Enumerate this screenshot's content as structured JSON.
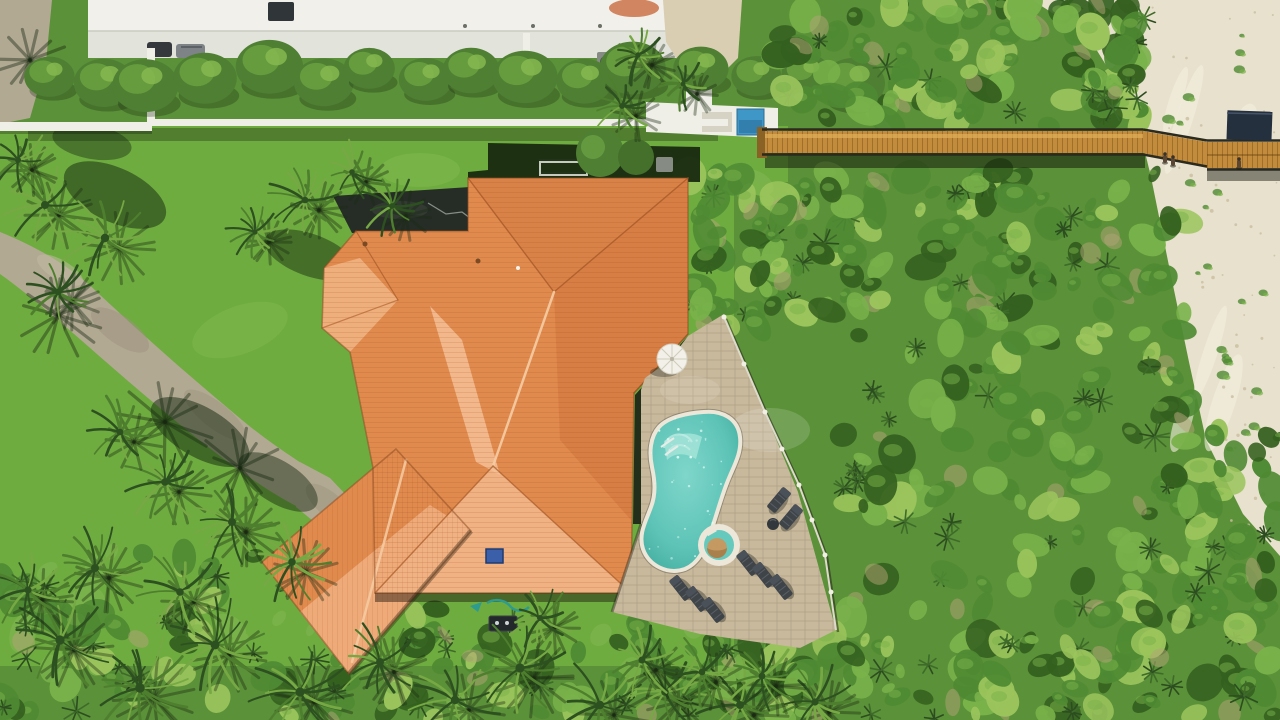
{
  "scene": {
    "description": "Aerial drone photo of a beachfront property: large home with orange terracotta hip roof, freeform turquoise pool with spa on a paver deck, green lawn, palm trees, concrete driveway, neighboring white flat-roof building with hedge row and small blue pool, dense dune scrub, and a wooden boardwalk crossing the dunes to white beach sand on the right.",
    "labels": {
      "house_roof": "orange tile hip roof",
      "pool": "freeform turquoise swimming pool",
      "spa": "round spa with tan cover",
      "boardwalk": "wooden dune crossover boardwalk",
      "beach": "white sand beach",
      "driveway": "concrete driveway",
      "neighbor_building": "white flat-roof building",
      "neighbor_pool": "small blue pool",
      "lawn": "green lawn",
      "scrub": "coastal dune scrub",
      "palms": "palm trees"
    }
  },
  "palette": {
    "lawn": "#6FAC40",
    "lawn_light": "#8CC455",
    "scrub_base": "#5B9138",
    "scrub_dark": "#34601F",
    "scrub_mid": "#4F8A33",
    "scrub_light": "#79B24A",
    "scrub_yellow": "#9BC45C",
    "tan_patch": "#B4A478",
    "sand": "#E8E1CD",
    "sand_light": "#F4EFE0",
    "sand_speck": "#C9BEA0",
    "concrete": "#B2A993",
    "concrete_dark": "#978E79",
    "white_roof": "#F1F0EA",
    "building_face": "#E2E4DC",
    "wall_white": "#EFEFE7",
    "pad_beige": "#D9CEB2",
    "neighbor_pool": "#3F97C8",
    "neighbor_pool_deep": "#2F78A6",
    "roof_main": "#E08A4E",
    "roof_pale": "#F1B283",
    "roof_dark": "#D0743C",
    "roof_valley": "#F4C096",
    "roof_line_dark": "#A85A28",
    "roof_line_light": "#F6CDA4",
    "flat_roof": "#262D26",
    "skylight_blue": "#3B5FA8",
    "band_dark": "#182A10",
    "lanai_dark": "#1C2318",
    "deck_paver": "#C8B99D",
    "pool_coping": "#ECE7D8",
    "pool_water": "#66C9BD",
    "pool_deep": "#45AFA2",
    "pool_shelf": "#A8E5DA",
    "spa_tan": "#C49A62",
    "spa_tan_dark": "#A97F4C",
    "chair_dark": "#3F4449",
    "chair_slat": "#595F66",
    "fence_light": "#DEDACB",
    "wood": "#C28C3C",
    "wood_light": "#DFAE58",
    "wood_dark": "#8A6226",
    "rail_dark": "#2B2A1E",
    "canopy": "#25303E",
    "palm_dark": "#2D5020",
    "palm_mid": "#4E7F2E",
    "palm_light": "#76A844",
    "shadow": "#1A2A12",
    "car_dark": "#35393E",
    "car_gray": "#7E8387",
    "umbrella": "#F2F0E8",
    "rust": "#C96A3F",
    "equip_gray": "#868B84",
    "hose_teal": "#2E9B8F",
    "table_dark": "#23282B"
  },
  "objects": {
    "palms": [
      {
        "x": 60,
        "y": 640,
        "r": 46
      },
      {
        "x": 140,
        "y": 688,
        "r": 48
      },
      {
        "x": 215,
        "y": 645,
        "r": 44
      },
      {
        "x": 300,
        "y": 692,
        "r": 46
      },
      {
        "x": 380,
        "y": 662,
        "r": 40
      },
      {
        "x": 455,
        "y": 700,
        "r": 42
      },
      {
        "x": 520,
        "y": 668,
        "r": 46
      },
      {
        "x": 600,
        "y": 705,
        "r": 42
      },
      {
        "x": 665,
        "y": 692,
        "r": 38
      },
      {
        "x": 740,
        "y": 705,
        "r": 40
      },
      {
        "x": 815,
        "y": 702,
        "r": 36
      },
      {
        "x": 95,
        "y": 568,
        "r": 40
      },
      {
        "x": 28,
        "y": 590,
        "r": 36
      },
      {
        "x": 180,
        "y": 592,
        "r": 38
      },
      {
        "x": 45,
        "y": 205,
        "r": 40
      },
      {
        "x": 105,
        "y": 238,
        "r": 42
      },
      {
        "x": 58,
        "y": 292,
        "r": 33
      },
      {
        "x": 18,
        "y": 160,
        "r": 30
      },
      {
        "x": 305,
        "y": 200,
        "r": 33
      },
      {
        "x": 352,
        "y": 172,
        "r": 28
      },
      {
        "x": 392,
        "y": 206,
        "r": 29
      },
      {
        "x": 255,
        "y": 232,
        "r": 26
      },
      {
        "x": 638,
        "y": 55,
        "r": 27
      },
      {
        "x": 622,
        "y": 106,
        "r": 29
      },
      {
        "x": 683,
        "y": 84,
        "r": 24
      },
      {
        "x": 165,
        "y": 482,
        "r": 38
      },
      {
        "x": 232,
        "y": 522,
        "r": 40
      },
      {
        "x": 292,
        "y": 562,
        "r": 38
      },
      {
        "x": 120,
        "y": 432,
        "r": 33
      },
      {
        "x": 642,
        "y": 660,
        "r": 35
      },
      {
        "x": 702,
        "y": 672,
        "r": 33
      },
      {
        "x": 762,
        "y": 676,
        "r": 34
      },
      {
        "x": 540,
        "y": 618,
        "r": 30
      }
    ],
    "scrub_zones": [
      {
        "x": 775,
        "y": 0,
        "w": 370,
        "h": 126,
        "n": 95
      },
      {
        "x": 1092,
        "y": 0,
        "w": 48,
        "h": 118,
        "n": 30
      },
      {
        "x": 688,
        "y": 170,
        "w": 92,
        "h": 160,
        "n": 42
      },
      {
        "x": 760,
        "y": 168,
        "w": 430,
        "h": 152,
        "n": 115
      },
      {
        "x": 840,
        "y": 320,
        "w": 360,
        "h": 300,
        "n": 125
      },
      {
        "x": 700,
        "y": 638,
        "w": 460,
        "h": 82,
        "n": 85
      },
      {
        "x": 330,
        "y": 608,
        "w": 400,
        "h": 112,
        "n": 70
      },
      {
        "x": 0,
        "y": 548,
        "w": 340,
        "h": 172,
        "n": 80
      },
      {
        "x": 1150,
        "y": 430,
        "w": 130,
        "h": 290,
        "n": 62
      }
    ],
    "hedge_row": {
      "x_start": 45,
      "x_end": 858,
      "y": 78,
      "count": 16
    },
    "chairs": [
      {
        "x": 779,
        "y": 500,
        "rot": 40
      },
      {
        "x": 791,
        "y": 517,
        "rot": 40
      },
      {
        "x": 748,
        "y": 563,
        "rot": -38
      },
      {
        "x": 764,
        "y": 575,
        "rot": -38
      },
      {
        "x": 781,
        "y": 587,
        "rot": -38
      },
      {
        "x": 681,
        "y": 588,
        "rot": -38
      },
      {
        "x": 697,
        "y": 599,
        "rot": -38
      },
      {
        "x": 713,
        "y": 610,
        "rot": -38
      }
    ],
    "side_table": {
      "x": 773,
      "y": 524,
      "r": 6
    },
    "people_on_boardwalk": [
      {
        "x": 1163,
        "y": 155
      },
      {
        "x": 1171,
        "y": 158
      },
      {
        "x": 1237,
        "y": 160
      }
    ],
    "drive_frond_shadows": [
      {
        "x": 58,
        "y": 315,
        "r": 42
      },
      {
        "x": 165,
        "y": 422,
        "r": 46
      },
      {
        "x": 240,
        "y": 468,
        "r": 40
      },
      {
        "x": 30,
        "y": 60,
        "r": 34
      }
    ],
    "sand_tufts": {
      "count": 26
    },
    "sand_speckles": {
      "count": 55
    },
    "pool_sparkles": {
      "count": 48
    }
  }
}
